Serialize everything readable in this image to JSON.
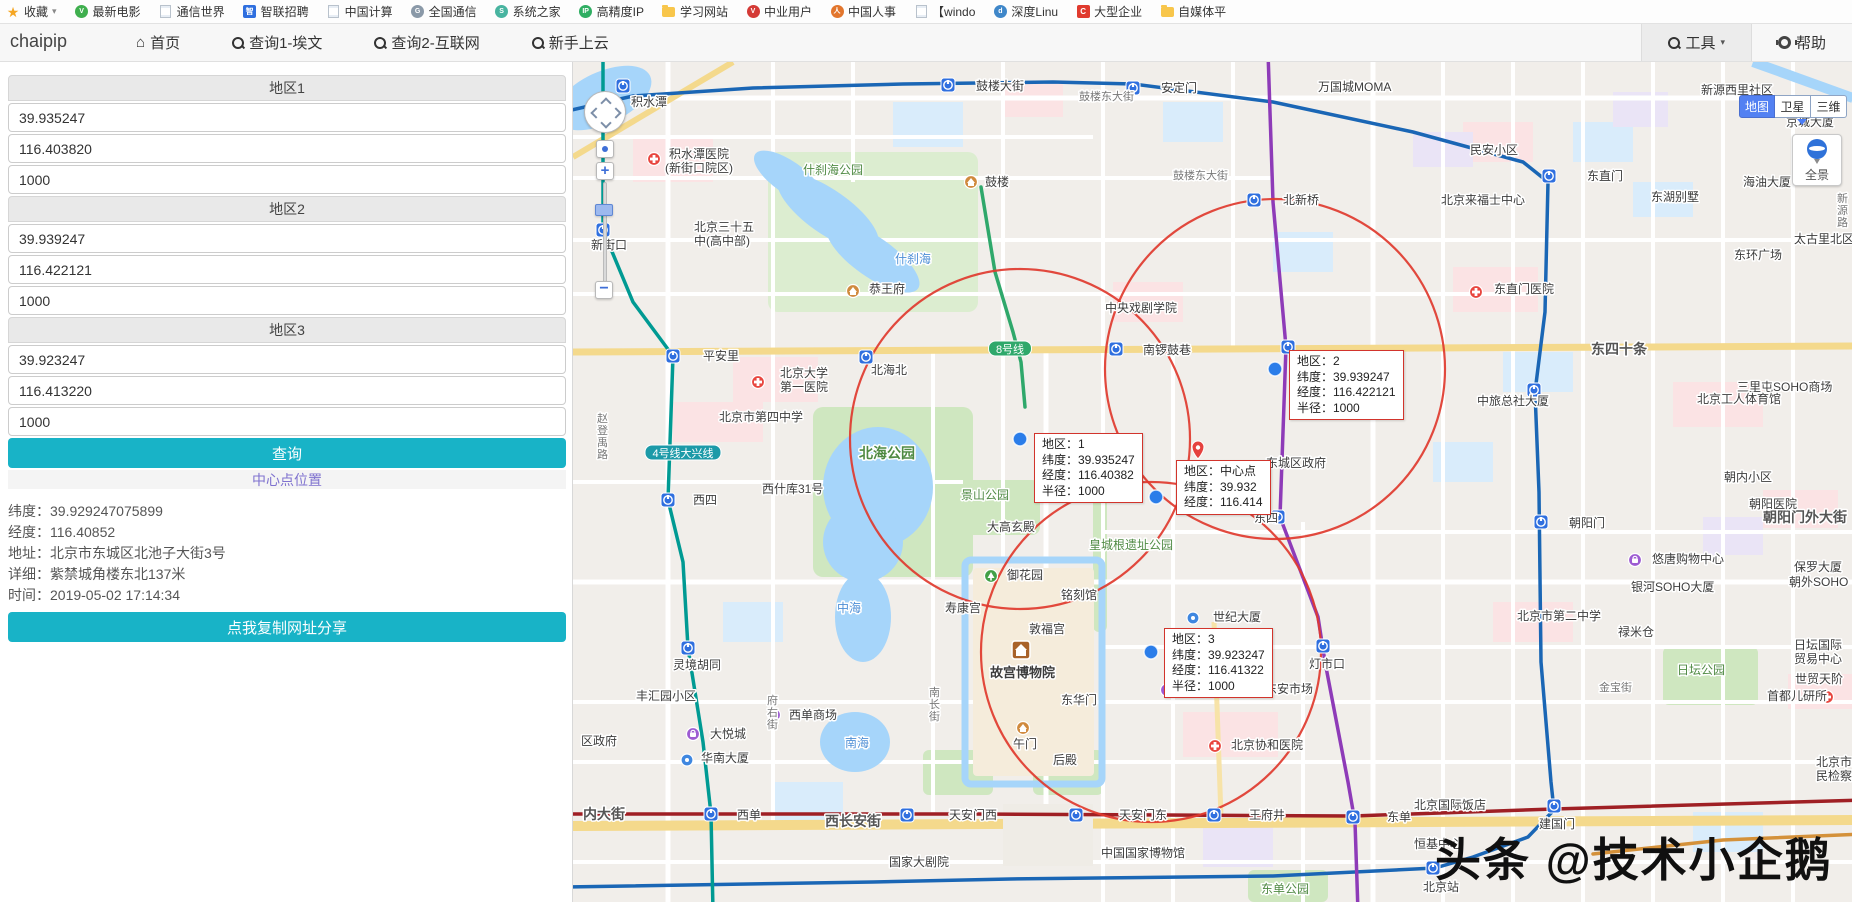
{
  "bookmarks_bar": {
    "items": [
      {
        "label": "收藏",
        "icon": "star",
        "caret": true
      },
      {
        "label": "最新电影",
        "icon": "rd",
        "color": "#3faf4e",
        "glyph": "V"
      },
      {
        "label": "通信世界",
        "icon": "page"
      },
      {
        "label": "智联招聘",
        "icon": "sq",
        "color": "#2f6fdf",
        "glyph": "智"
      },
      {
        "label": "中国计算",
        "icon": "page"
      },
      {
        "label": "全国通信",
        "icon": "rd",
        "color": "#8a99a8",
        "glyph": "G"
      },
      {
        "label": "系统之家",
        "icon": "rd",
        "color": "#48b4a0",
        "glyph": "S"
      },
      {
        "label": "高精度IP",
        "icon": "rd",
        "color": "#2fae62",
        "glyph": "IP"
      },
      {
        "label": "学习网站",
        "icon": "folder"
      },
      {
        "label": "中业用户",
        "icon": "rd",
        "color": "#d43a36",
        "glyph": "V"
      },
      {
        "label": "中国人事",
        "icon": "rd",
        "color": "#e2762d",
        "glyph": "人"
      },
      {
        "label": "【windo",
        "icon": "page"
      },
      {
        "label": "深度Linu",
        "icon": "rd",
        "color": "#3f87c9",
        "glyph": "d"
      },
      {
        "label": "大型企业",
        "icon": "sq",
        "color": "#e03a2e",
        "glyph": "C"
      },
      {
        "label": "自媒体平",
        "icon": "folder"
      }
    ]
  },
  "nav": {
    "brand": "chaipip",
    "items": [
      {
        "label": "首页",
        "icon": "home"
      },
      {
        "label": "查询1-埃文",
        "icon": "search"
      },
      {
        "label": "查询2-互联网",
        "icon": "search"
      },
      {
        "label": "新手上云",
        "icon": "search"
      }
    ],
    "right": [
      {
        "label": "工具",
        "icon": "search",
        "caret": true
      },
      {
        "label": "帮助",
        "icon": "gear"
      }
    ]
  },
  "sidebar": {
    "groups": [
      {
        "title": "地区1",
        "lat": "39.935247",
        "lng": "116.403820",
        "radius": "1000"
      },
      {
        "title": "地区2",
        "lat": "39.939247",
        "lng": "116.422121",
        "radius": "1000"
      },
      {
        "title": "地区3",
        "lat": "39.923247",
        "lng": "116.413220",
        "radius": "1000"
      }
    ],
    "query_button": "查询",
    "center_link": "中心点位置",
    "info": [
      {
        "label": "纬度",
        "value": "39.929247075899"
      },
      {
        "label": "经度",
        "value": "116.40852"
      },
      {
        "label": "地址",
        "value": "北京市东城区北池子大街3号"
      },
      {
        "label": "详细",
        "value": "紫禁城角楼东北137米"
      },
      {
        "label": "时间",
        "value": "2019-05-02 17:14:34"
      }
    ],
    "copy_button": "点我复制网址分享"
  },
  "map": {
    "type_buttons": [
      {
        "label": "地图",
        "active": true
      },
      {
        "label": "卫星",
        "active": false
      },
      {
        "label": "三维",
        "active": false
      }
    ],
    "panorama_label": "全景",
    "watermark": "头条 @技术小企鹅",
    "accent_red": "#e03a2e",
    "dot_blue": "#2b7de9",
    "circles": [
      {
        "name": "region-1",
        "cx": 447,
        "cy": 377,
        "r": 170
      },
      {
        "name": "region-2",
        "cx": 702,
        "cy": 307,
        "r": 170
      },
      {
        "name": "region-3",
        "cx": 578,
        "cy": 590,
        "r": 170
      }
    ],
    "dots": [
      {
        "name": "region-1-marker",
        "x": 447,
        "y": 377
      },
      {
        "name": "region-2-marker",
        "x": 702,
        "y": 307
      },
      {
        "name": "region-3-marker",
        "x": 578,
        "y": 590
      },
      {
        "name": "center-marker",
        "x": 583,
        "y": 435
      }
    ],
    "tooltips": [
      {
        "x": 461,
        "y": 371,
        "lines": [
          "地区：1",
          "纬度：39.935247",
          "经度：116.40382",
          "半径：1000"
        ]
      },
      {
        "x": 716,
        "y": 288,
        "lines": [
          "地区：2",
          "纬度：39.939247",
          "经度：116.422121",
          "半径：1000"
        ]
      },
      {
        "x": 591,
        "y": 566,
        "lines": [
          "地区：3",
          "纬度：39.923247",
          "经度：116.41322",
          "半径：1000"
        ]
      },
      {
        "x": 603,
        "y": 398,
        "lines": [
          "地区：中心点",
          "纬度：39.932",
          "经度：116.414"
        ]
      }
    ],
    "line_badges": [
      {
        "label": "8号线",
        "x": 437,
        "y": 287,
        "color": "#2fa86b"
      },
      {
        "label": "4号线大兴线",
        "x": 110,
        "y": 391,
        "color": "#1c9aa8"
      }
    ],
    "labels": [
      {
        "t": "积水潭",
        "x": 58,
        "y": 44,
        "c": "poi"
      },
      {
        "t": "鼓楼大街",
        "x": 403,
        "y": 28,
        "c": "poi"
      },
      {
        "t": "安定门",
        "x": 588,
        "y": 30,
        "c": "poi"
      },
      {
        "t": "万国城MOMA",
        "x": 745,
        "y": 29,
        "c": "poi"
      },
      {
        "t": "新源西里社区",
        "x": 1128,
        "y": 32,
        "c": "poi"
      },
      {
        "t": "京城大厦",
        "x": 1213,
        "y": 64,
        "c": "poi"
      },
      {
        "t": "鼓楼东大街",
        "x": 506,
        "y": 38,
        "c": "street"
      },
      {
        "t": "积水潭医院",
        "x": 96,
        "y": 96,
        "c": "poi"
      },
      {
        "t": "(新街口院区)",
        "x": 92,
        "y": 110,
        "c": "poi"
      },
      {
        "t": "什刹海公园",
        "x": 230,
        "y": 112,
        "c": "park"
      },
      {
        "t": "鼓楼",
        "x": 412,
        "y": 124,
        "c": "poi"
      },
      {
        "t": "鼓楼东大街",
        "x": 600,
        "y": 117,
        "c": "street"
      },
      {
        "t": "北新桥",
        "x": 710,
        "y": 142,
        "c": "poi"
      },
      {
        "t": "北京来福士中心",
        "x": 868,
        "y": 142,
        "c": "poi"
      },
      {
        "t": "东湖别墅",
        "x": 1078,
        "y": 139,
        "c": "poi"
      },
      {
        "t": "海油大厦",
        "x": 1170,
        "y": 124,
        "c": "poi"
      },
      {
        "t": "民安小区",
        "x": 897,
        "y": 92,
        "c": "poi"
      },
      {
        "t": "东直门",
        "x": 1014,
        "y": 118,
        "c": "poi"
      },
      {
        "t": "新源路",
        "x": 1264,
        "y": 140,
        "c": "street-v"
      },
      {
        "t": "太古里北区",
        "x": 1221,
        "y": 181,
        "c": "poi"
      },
      {
        "t": "东环广场",
        "x": 1161,
        "y": 197,
        "c": "poi"
      },
      {
        "t": "北京三十五",
        "x": 121,
        "y": 169,
        "c": "poi"
      },
      {
        "t": "中(高中部)",
        "x": 121,
        "y": 183,
        "c": "poi"
      },
      {
        "t": "新街口",
        "x": 18,
        "y": 187,
        "c": "poi"
      },
      {
        "t": "什刹海",
        "x": 322,
        "y": 201,
        "c": "water"
      },
      {
        "t": "恭王府",
        "x": 296,
        "y": 231,
        "c": "poi"
      },
      {
        "t": "中央戏剧学院",
        "x": 532,
        "y": 250,
        "c": "poi"
      },
      {
        "t": "东直门医院",
        "x": 921,
        "y": 231,
        "c": "poi"
      },
      {
        "t": "平安里",
        "x": 130,
        "y": 298,
        "c": "poi"
      },
      {
        "t": "北海北",
        "x": 298,
        "y": 312,
        "c": "poi"
      },
      {
        "t": "南锣鼓巷",
        "x": 570,
        "y": 292,
        "c": "poi"
      },
      {
        "t": "东四十条",
        "x": 1018,
        "y": 292,
        "c": "street-big"
      },
      {
        "t": "三里屯SOHO商场",
        "x": 1164,
        "y": 329,
        "c": "poi"
      },
      {
        "t": "北京工人体育馆",
        "x": 1124,
        "y": 341,
        "c": "poi"
      },
      {
        "t": "北京大学",
        "x": 207,
        "y": 315,
        "c": "poi"
      },
      {
        "t": "第一医院",
        "x": 207,
        "y": 329,
        "c": "poi"
      },
      {
        "t": "北京市第四中学",
        "x": 146,
        "y": 359,
        "c": "poi"
      },
      {
        "t": "赵登禹路",
        "x": 24,
        "y": 360,
        "c": "street-v"
      },
      {
        "t": "西什库31号",
        "x": 189,
        "y": 431,
        "c": "poi"
      },
      {
        "t": "北海公园",
        "x": 286,
        "y": 396,
        "c": "park-big"
      },
      {
        "t": "景山公园",
        "x": 388,
        "y": 437,
        "c": "park"
      },
      {
        "t": "大高玄殿",
        "x": 414,
        "y": 469,
        "c": "poi"
      },
      {
        "t": "中旅总社大厦",
        "x": 904,
        "y": 343,
        "c": "poi"
      },
      {
        "t": "东城区政府",
        "x": 693,
        "y": 405,
        "c": "poi"
      },
      {
        "t": "东四",
        "x": 681,
        "y": 460,
        "c": "poi"
      },
      {
        "t": "西四",
        "x": 120,
        "y": 442,
        "c": "poi"
      },
      {
        "t": "朝阳门",
        "x": 996,
        "y": 465,
        "c": "poi"
      },
      {
        "t": "朝内小区",
        "x": 1151,
        "y": 419,
        "c": "poi"
      },
      {
        "t": "朝阳门外大街",
        "x": 1190,
        "y": 460,
        "c": "street-big"
      },
      {
        "t": "朝阳医院",
        "x": 1176,
        "y": 446,
        "c": "poi"
      },
      {
        "t": "皇城根遗址公园",
        "x": 516,
        "y": 487,
        "c": "park"
      },
      {
        "t": "悠唐购物中心",
        "x": 1079,
        "y": 501,
        "c": "poi"
      },
      {
        "t": "保罗大厦",
        "x": 1221,
        "y": 509,
        "c": "poi"
      },
      {
        "t": "银河SOHO大厦",
        "x": 1058,
        "y": 529,
        "c": "poi"
      },
      {
        "t": "朝外SOHO",
        "x": 1216,
        "y": 524,
        "c": "poi"
      },
      {
        "t": "御花园",
        "x": 434,
        "y": 517,
        "c": "poi"
      },
      {
        "t": "铭刻馆",
        "x": 488,
        "y": 537,
        "c": "poi"
      },
      {
        "t": "中海",
        "x": 264,
        "y": 550,
        "c": "water"
      },
      {
        "t": "寿康宫",
        "x": 372,
        "y": 550,
        "c": "poi"
      },
      {
        "t": "世纪大厦",
        "x": 640,
        "y": 559,
        "c": "poi"
      },
      {
        "t": "北京市第二中学",
        "x": 944,
        "y": 558,
        "c": "poi"
      },
      {
        "t": "禄米仓",
        "x": 1045,
        "y": 574,
        "c": "poi"
      },
      {
        "t": "敦福宫",
        "x": 456,
        "y": 571,
        "c": "poi"
      },
      {
        "t": "故宫博物院",
        "x": 417,
        "y": 615,
        "c": "poi-big"
      },
      {
        "t": "日坛公园",
        "x": 1104,
        "y": 612,
        "c": "park"
      },
      {
        "t": "日坛国际",
        "x": 1221,
        "y": 587,
        "c": "poi"
      },
      {
        "t": "贸易中心",
        "x": 1221,
        "y": 601,
        "c": "poi"
      },
      {
        "t": "世贸天阶",
        "x": 1222,
        "y": 621,
        "c": "poi"
      },
      {
        "t": "灯市口",
        "x": 736,
        "y": 606,
        "c": "poi"
      },
      {
        "t": "金宝街",
        "x": 1026,
        "y": 629,
        "c": "street"
      },
      {
        "t": "首都儿研所",
        "x": 1194,
        "y": 638,
        "c": "poi"
      },
      {
        "t": "东华门",
        "x": 488,
        "y": 642,
        "c": "poi"
      },
      {
        "t": "王府井百货",
        "x": 609,
        "y": 631,
        "c": "poi"
      },
      {
        "t": "东安市场",
        "x": 692,
        "y": 631,
        "c": "poi"
      },
      {
        "t": "灵境胡同",
        "x": 100,
        "y": 607,
        "c": "poi"
      },
      {
        "t": "丰汇园小区",
        "x": 63,
        "y": 638,
        "c": "poi"
      },
      {
        "t": "大悦城",
        "x": 137,
        "y": 676,
        "c": "poi"
      },
      {
        "t": "西单商场",
        "x": 216,
        "y": 657,
        "c": "poi"
      },
      {
        "t": "华南大厦",
        "x": 128,
        "y": 700,
        "c": "poi"
      },
      {
        "t": "区政府",
        "x": 8,
        "y": 683,
        "c": "poi"
      },
      {
        "t": "府右街",
        "x": 194,
        "y": 642,
        "c": "street-v"
      },
      {
        "t": "南长街",
        "x": 356,
        "y": 634,
        "c": "street-v"
      },
      {
        "t": "午门",
        "x": 440,
        "y": 686,
        "c": "poi"
      },
      {
        "t": "后殿",
        "x": 480,
        "y": 702,
        "c": "poi"
      },
      {
        "t": "南海",
        "x": 272,
        "y": 685,
        "c": "water"
      },
      {
        "t": "北京协和医院",
        "x": 658,
        "y": 687,
        "c": "poi"
      },
      {
        "t": "西单",
        "x": 164,
        "y": 757,
        "c": "poi"
      },
      {
        "t": "天安门西",
        "x": 376,
        "y": 757,
        "c": "poi"
      },
      {
        "t": "天安门东",
        "x": 546,
        "y": 757,
        "c": "poi"
      },
      {
        "t": "王府井",
        "x": 676,
        "y": 757,
        "c": "poi"
      },
      {
        "t": "东单",
        "x": 814,
        "y": 759,
        "c": "poi"
      },
      {
        "t": "建国门",
        "x": 966,
        "y": 766,
        "c": "poi"
      },
      {
        "t": "西长安街",
        "x": 252,
        "y": 764,
        "c": "street-big"
      },
      {
        "t": "内大街",
        "x": 10,
        "y": 757,
        "c": "street-big"
      },
      {
        "t": "北京国际饭店",
        "x": 841,
        "y": 747,
        "c": "poi"
      },
      {
        "t": "恒基中心",
        "x": 841,
        "y": 786,
        "c": "poi"
      },
      {
        "t": "中国国家博物馆",
        "x": 528,
        "y": 795,
        "c": "poi"
      },
      {
        "t": "国家大剧院",
        "x": 316,
        "y": 804,
        "c": "poi"
      },
      {
        "t": "东单公园",
        "x": 688,
        "y": 831,
        "c": "park"
      },
      {
        "t": "北京站",
        "x": 850,
        "y": 829,
        "c": "poi"
      },
      {
        "t": "北京市人",
        "x": 1243,
        "y": 704,
        "c": "poi"
      },
      {
        "t": "民检察院",
        "x": 1243,
        "y": 718,
        "c": "poi"
      }
    ],
    "icons": [
      {
        "k": "metro",
        "x": 50,
        "y": 24
      },
      {
        "k": "metro",
        "x": 375,
        "y": 23
      },
      {
        "k": "metro",
        "x": 560,
        "y": 26
      },
      {
        "k": "metro",
        "x": 681,
        "y": 138
      },
      {
        "k": "metro",
        "x": 976,
        "y": 114
      },
      {
        "k": "metro",
        "x": 30,
        "y": 168
      },
      {
        "k": "metro",
        "x": 100,
        "y": 294
      },
      {
        "k": "metro",
        "x": 293,
        "y": 295
      },
      {
        "k": "metro",
        "x": 543,
        "y": 287
      },
      {
        "k": "metro",
        "x": 715,
        "y": 285
      },
      {
        "k": "metro",
        "x": 961,
        "y": 328
      },
      {
        "k": "metro",
        "x": 705,
        "y": 455
      },
      {
        "k": "metro",
        "x": 95,
        "y": 438
      },
      {
        "k": "metro",
        "x": 750,
        "y": 584
      },
      {
        "k": "metro",
        "x": 968,
        "y": 460
      },
      {
        "k": "metro",
        "x": 138,
        "y": 752
      },
      {
        "k": "metro",
        "x": 334,
        "y": 753
      },
      {
        "k": "metro",
        "x": 503,
        "y": 753
      },
      {
        "k": "metro",
        "x": 641,
        "y": 753
      },
      {
        "k": "metro",
        "x": 780,
        "y": 755
      },
      {
        "k": "metro",
        "x": 981,
        "y": 744
      },
      {
        "k": "metro",
        "x": 860,
        "y": 806
      },
      {
        "k": "metro",
        "x": 115,
        "y": 586
      },
      {
        "k": "hospital",
        "x": 81,
        "y": 97
      },
      {
        "k": "hospital",
        "x": 903,
        "y": 230
      },
      {
        "k": "hospital",
        "x": 185,
        "y": 320
      },
      {
        "k": "hospital",
        "x": 1214,
        "y": 444
      },
      {
        "k": "hospital",
        "x": 642,
        "y": 684
      },
      {
        "k": "hospital",
        "x": 1254,
        "y": 635
      },
      {
        "k": "shop",
        "x": 675,
        "y": 627
      },
      {
        "k": "shop",
        "x": 120,
        "y": 672
      },
      {
        "k": "shop",
        "x": 201,
        "y": 653
      },
      {
        "k": "shop",
        "x": 1062,
        "y": 498
      },
      {
        "k": "shop",
        "x": 594,
        "y": 628
      },
      {
        "k": "attraction",
        "x": 280,
        "y": 229
      },
      {
        "k": "attraction",
        "x": 450,
        "y": 666
      },
      {
        "k": "attraction",
        "x": 398,
        "y": 120
      },
      {
        "k": "park",
        "x": 418,
        "y": 514
      },
      {
        "k": "bigattraction",
        "x": 448,
        "y": 588
      },
      {
        "k": "pin",
        "x": 625,
        "y": 390
      },
      {
        "k": "poidot",
        "x": 620,
        "y": 556
      },
      {
        "k": "poidot",
        "x": 114,
        "y": 698
      }
    ]
  }
}
